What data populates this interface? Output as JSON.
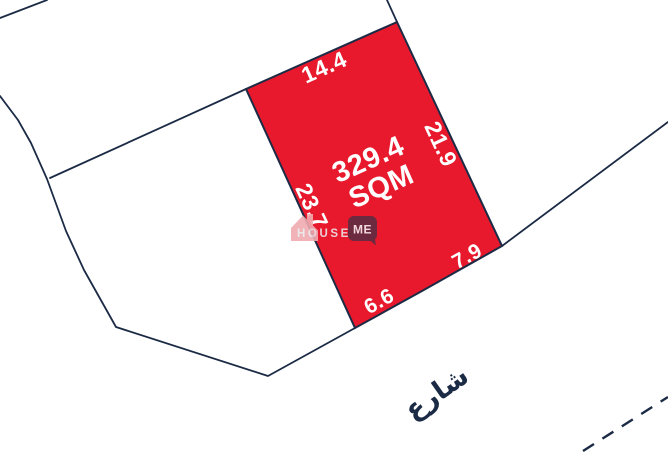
{
  "map": {
    "plot": {
      "area_value": "329.4",
      "area_unit": "SQM",
      "dim_top": "14.4",
      "dim_right": "21.9",
      "dim_left": "23.7",
      "dim_bottom_left": "6.6",
      "dim_bottom_right": "7.9"
    },
    "street_label": "شارع"
  },
  "watermark": {
    "brand_first": "HOUSE",
    "brand_second": "ME"
  },
  "colors": {
    "plot_fill": "#e8192d",
    "boundary_line": "#1c2b45",
    "dimension_text": "#ffffff",
    "street_text": "#1c2b45",
    "watermark_house": "#f0abb0",
    "watermark_brand_text": "#ece6e8",
    "watermark_me_badge": "#5e2c41",
    "watermark_me_text": "#f6edf1"
  }
}
